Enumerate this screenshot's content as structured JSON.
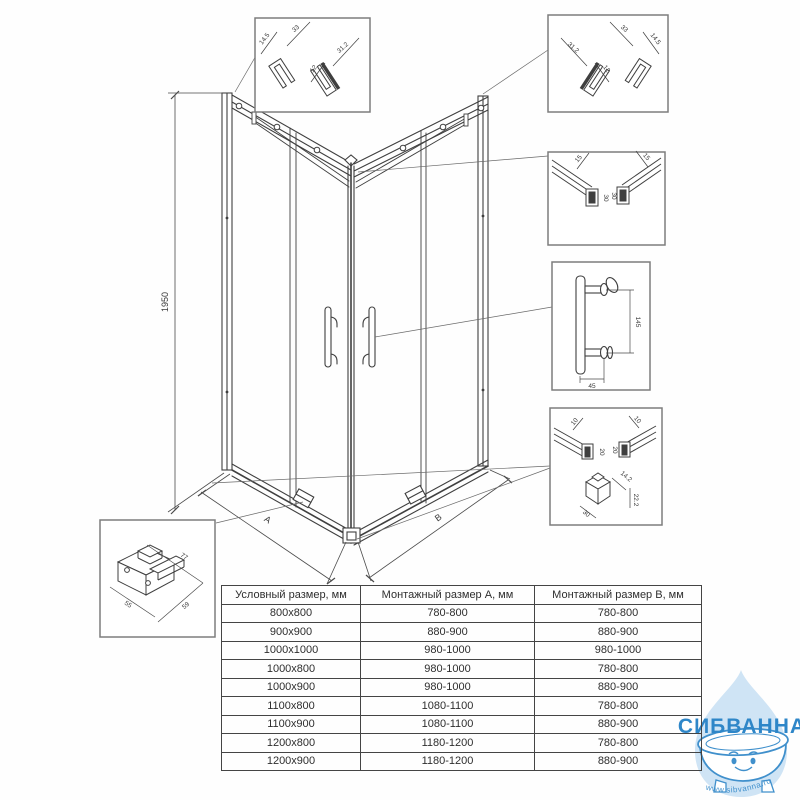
{
  "drawing": {
    "height_dim": "1950",
    "width_a_label": "A",
    "width_b_label": "B"
  },
  "details": {
    "top_left_profile": {
      "dims": [
        "14.5",
        "33",
        "12",
        "31.2"
      ]
    },
    "top_right_profile": {
      "dims": [
        "31.2",
        "12",
        "33",
        "14.5"
      ]
    },
    "top_rail_section": {
      "dims": [
        "15",
        "30",
        "15",
        "30"
      ]
    },
    "door_handle": {
      "dims": [
        "145",
        "45"
      ]
    },
    "bottom_rail_corner": {
      "dims": [
        "10",
        "10",
        "20",
        "20",
        "14.2",
        "22.2",
        "30"
      ]
    },
    "roller_carriage": {
      "dims": [
        "77",
        "55",
        "59"
      ]
    }
  },
  "size_table": {
    "headers": [
      "Условный размер, мм",
      "Монтажный размер А, мм",
      "Монтажный размер В, мм"
    ],
    "rows": [
      [
        "800x800",
        "780-800",
        "780-800"
      ],
      [
        "900x900",
        "880-900",
        "880-900"
      ],
      [
        "1000x1000",
        "980-1000",
        "980-1000"
      ],
      [
        "1000x800",
        "980-1000",
        "780-800"
      ],
      [
        "1000x900",
        "980-1000",
        "880-900"
      ],
      [
        "1100x800",
        "1080-1100",
        "780-800"
      ],
      [
        "1100x900",
        "1080-1100",
        "880-900"
      ],
      [
        "1200x800",
        "1180-1200",
        "780-800"
      ],
      [
        "1200x900",
        "1180-1200",
        "880-900"
      ]
    ]
  },
  "watermark": {
    "brand": "СИБВАННА",
    "url": "www.sibvanna.ru",
    "brand_color": "#2e86c8",
    "drop_color": "#cfe4f5",
    "outline_color": "#4090cc"
  },
  "colors": {
    "line": "#3f3f3f",
    "box_border": "#7d7d7d",
    "table_border": "#444444"
  }
}
